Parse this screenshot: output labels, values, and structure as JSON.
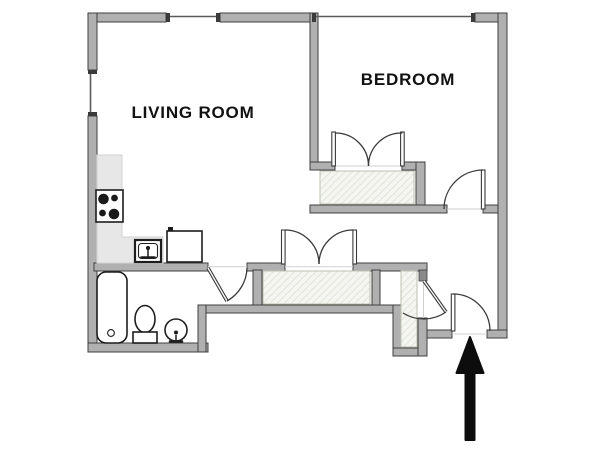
{
  "title": "Apartment floor plan",
  "rooms": [
    {
      "id": "living-room",
      "label": "LIVING ROOM"
    },
    {
      "id": "bedroom",
      "label": "BEDROOM"
    }
  ],
  "fixtures": [
    "stove",
    "kitchen-sink",
    "refrigerator",
    "kitchen-counter",
    "bathtub",
    "toilet",
    "pedestal-sink"
  ],
  "storage": [
    "bedroom-closet",
    "hall-closet",
    "entry-closet"
  ],
  "icons": {
    "entrance": "up-arrow"
  },
  "colors": {
    "wall_fill": "#b0b0b0",
    "wall_stroke": "#3f3f3f",
    "window_line": "#5a5a5a",
    "hatch_bg": "#f5f6f1",
    "hatch_line": "#dde1d5",
    "hatch_border": "#bcc2b2",
    "counter_fill": "#e7e7e7",
    "counter_border": "#d2d2d2",
    "fixture_stroke": "#1d1d1d",
    "door_stroke": "#3a3a3a",
    "threshold": "#cfcfcf",
    "arrow": "#0d0d0d",
    "label": "#111111",
    "background": "#ffffff"
  }
}
